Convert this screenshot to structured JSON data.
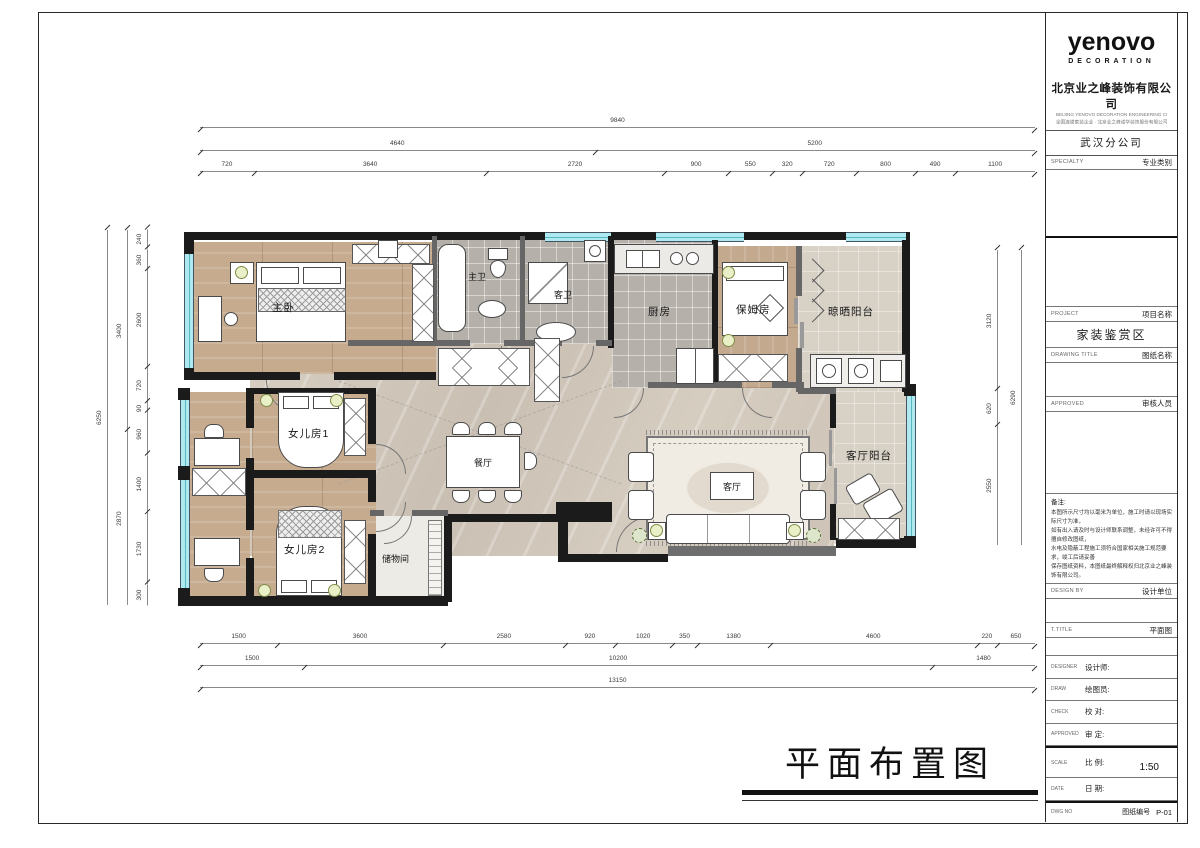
{
  "titleblock": {
    "logo": "yenovo",
    "logo_sub": "DECORATION",
    "company_cn": "北京业之峰装饰有限公司",
    "company_en": "BEIJING YENOVO DECORATION ENGINEERING CO.,LTD",
    "company_line2": "全国连锁家装企业 · 北京业之峰诺华装饰股份有限公司",
    "branch": "武汉分公司",
    "specialty": {
      "en": "SPECIALTY",
      "cn": "专业类别"
    },
    "project": {
      "en": "PROJECT",
      "cn": "项目名称",
      "value": "家装鉴赏区"
    },
    "drawing": {
      "en": "DRAWING TITLE",
      "cn": "图纸名称"
    },
    "approved_by": {
      "en": "APPROVED",
      "cn": "审核人员"
    },
    "notes_title": "备注:",
    "notes": [
      "本图所示尺寸均以毫米为单位，施工时请以现场实际尺寸为准，",
      "如有出入请及时与设计师联系调整，未经许可不得擅自修改图纸，",
      "水电及隐蔽工程施工须符合国家相关施工规范要求，竣工后请妥善",
      "保存图纸资料，本图纸最终解释权归北京业之峰装饰有限公司。"
    ],
    "design_by": {
      "en": "DESIGN BY",
      "cn": "设计单位"
    },
    "t_title": {
      "en": "T.TITLE",
      "cn": "平面图"
    },
    "designer": {
      "en": "DESIGNER",
      "cn": "设计师:"
    },
    "draw": {
      "en": "DRAW",
      "cn": "绘图员:"
    },
    "check": {
      "en": "CHECK",
      "cn": "校 对:"
    },
    "approved": {
      "en": "APPROVED",
      "cn": "审 定:"
    },
    "scale": {
      "en": "SCALE",
      "cn": "比 例:",
      "value": "1:50"
    },
    "date": {
      "en": "DATE",
      "cn": "日 期:"
    },
    "dwg": {
      "en": "DWG NO",
      "cn": "图纸编号",
      "value": "P-01"
    }
  },
  "plan_title": "平面布置图",
  "rooms": {
    "master": {
      "label": "主卧"
    },
    "master_bath": {
      "label": "主卫"
    },
    "guest_bath": {
      "label": "客卫"
    },
    "kitchen": {
      "label": "厨房"
    },
    "nanny": {
      "label": "保姆房"
    },
    "dry_balcony": {
      "label": "晾晒阳台"
    },
    "living_balcony": {
      "label": "客厅阳台"
    },
    "living": {
      "label": "客厅"
    },
    "dining": {
      "label": "餐厅"
    },
    "girl1": {
      "label": "女儿房1"
    },
    "girl2": {
      "label": "女儿房2"
    },
    "storage": {
      "label": "储物间"
    }
  },
  "dims": {
    "top": {
      "total": "9840",
      "tier2": [
        "4640",
        "5200"
      ],
      "tier3": [
        "720",
        "3640",
        "2720",
        "900",
        "550",
        "320",
        "720",
        "800",
        "490",
        "1100"
      ]
    },
    "bottom": {
      "tier1": [
        "1500",
        "3600",
        "2580",
        "920",
        "1020",
        "350",
        "1380",
        "4600",
        "220",
        "650"
      ],
      "tier2": [
        "1500",
        "10200",
        "1480"
      ],
      "total": "13150"
    },
    "left": {
      "tier3": [
        "240",
        "360",
        "2600",
        "720",
        "90",
        "960",
        "1400",
        "1730",
        "300"
      ],
      "tier2": [
        "3400",
        "2870"
      ],
      "total": "6250"
    },
    "right": {
      "tier2": [
        "3120",
        "620",
        "2550"
      ],
      "total": "6290"
    }
  },
  "colors": {
    "window_glass": "#aee9ef",
    "wall": "#1b1b1b",
    "wood_floor": "#c6ab8f",
    "tile_floor": "#b5b0aa",
    "accent_lamp": "#e9efc6"
  }
}
